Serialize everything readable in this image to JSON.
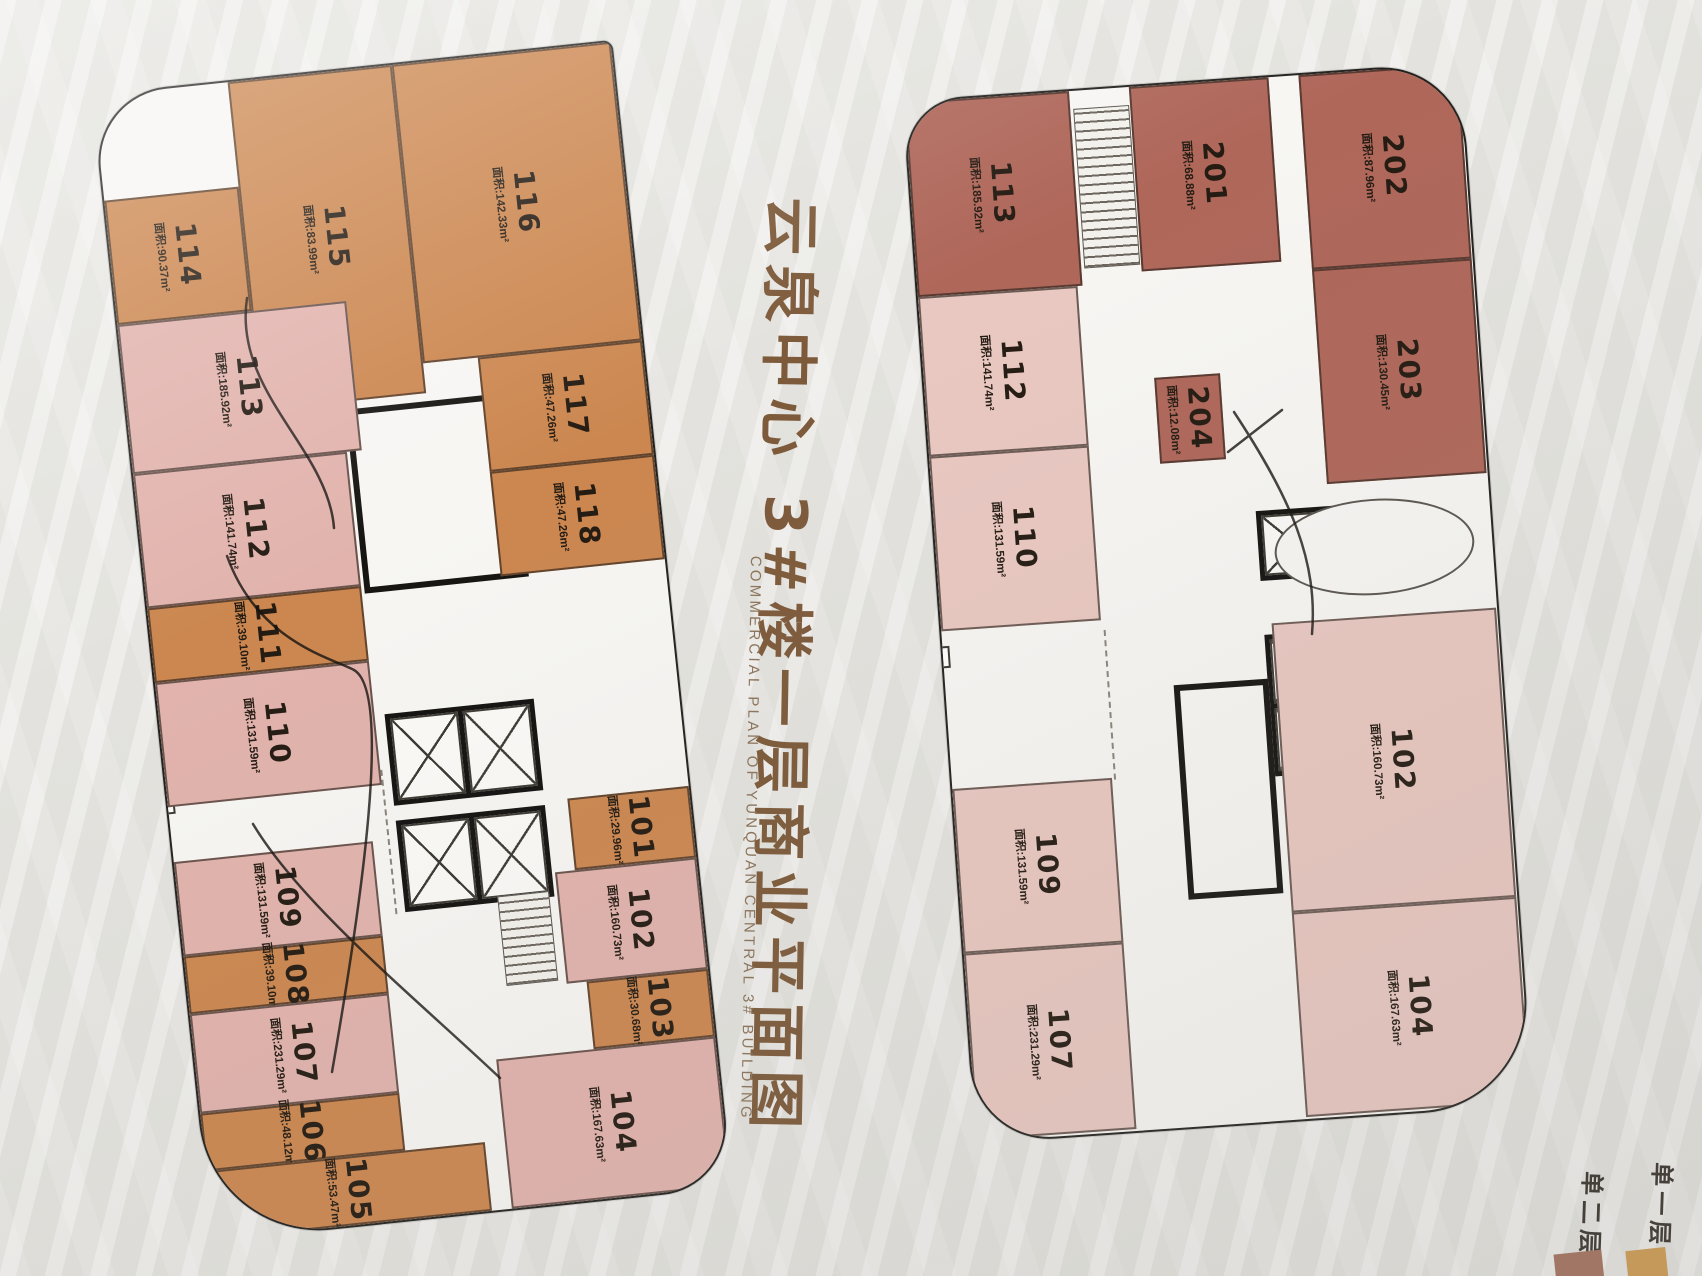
{
  "title": {
    "cn": "云泉中心 3#楼一层商业平面图",
    "en": "COMMERCIAL PLAN OF YUNQUAN CENTRAL 3# BUILDING"
  },
  "area_prefix": "面积:",
  "legend": {
    "items": [
      {
        "label": "单二层",
        "color": "#a3705c"
      },
      {
        "label": "单一层",
        "color": "#cf9a4f"
      }
    ]
  },
  "colors": {
    "single_story_orange": "#cc8750",
    "two_story_brick": "#af675a",
    "pink_unit_left": "#e2b3ad",
    "pink_unit_right": "#e9c8c1",
    "plan_background": "#f7f6f3",
    "title_brown": "#7d5a3a"
  },
  "left_plan": {
    "units": [
      {
        "id": "114",
        "area": "90.37m²",
        "type": "orange",
        "rect": [
          0,
          105,
          135,
          125
        ]
      },
      {
        "id": "115",
        "area": "83.99m²",
        "type": "orange",
        "rect": [
          135,
          0,
          165,
          330
        ]
      },
      {
        "id": "116",
        "area": "142.33m²",
        "type": "orange",
        "rect": [
          300,
          0,
          220,
          300
        ]
      },
      {
        "id": "117",
        "area": "47.26m²",
        "type": "orange",
        "rect": [
          355,
          300,
          165,
          115
        ]
      },
      {
        "id": "118",
        "area": "47.26m²",
        "type": "orange",
        "rect": [
          355,
          415,
          165,
          105
        ]
      },
      {
        "id": "113",
        "area": "185.92m²",
        "type": "pink",
        "rect": [
          0,
          230,
          230,
          150
        ]
      },
      {
        "id": "112",
        "area": "141.74m²",
        "type": "pink",
        "rect": [
          0,
          380,
          215,
          135
        ]
      },
      {
        "id": "111",
        "area": "39.10m²",
        "type": "orange",
        "rect": [
          0,
          515,
          215,
          75
        ]
      },
      {
        "id": "110",
        "area": "131.59m²",
        "type": "pink",
        "rect": [
          0,
          590,
          215,
          125
        ]
      },
      {
        "id": "109",
        "area": "131.59m²",
        "type": "pink",
        "rect": [
          0,
          770,
          200,
          95
        ]
      },
      {
        "id": "108",
        "area": "39.10m²",
        "type": "orange",
        "rect": [
          0,
          865,
          200,
          58
        ]
      },
      {
        "id": "107",
        "area": "231.29m²",
        "type": "pink",
        "rect": [
          0,
          923,
          200,
          100
        ]
      },
      {
        "id": "106",
        "area": "48.12m²",
        "type": "orange",
        "rect": [
          0,
          1023,
          200,
          58
        ]
      },
      {
        "id": "105",
        "area": "53.47m²",
        "type": "orange",
        "rect": [
          0,
          1081,
          280,
          69
        ]
      },
      {
        "id": "101",
        "area": "29.96m²",
        "type": "orange",
        "rect": [
          398,
          748,
          122,
          72
        ]
      },
      {
        "id": "102",
        "area": "160.73m²",
        "type": "pink",
        "rect": [
          378,
          820,
          142,
          112
        ]
      },
      {
        "id": "103",
        "area": "30.68m²",
        "type": "orange",
        "rect": [
          398,
          932,
          122,
          68
        ]
      },
      {
        "id": "104",
        "area": "167.63m²",
        "type": "pink",
        "rect": [
          300,
          1000,
          220,
          150
        ]
      }
    ]
  },
  "right_plan": {
    "units": [
      {
        "id": "113",
        "area": "185.92m²",
        "type": "brick",
        "rect": [
          0,
          0,
          165,
          195
        ]
      },
      {
        "id": "201",
        "area": "68.88m²",
        "type": "brick",
        "rect": [
          225,
          0,
          140,
          185
        ]
      },
      {
        "id": "202",
        "area": "87.96m²",
        "type": "brick",
        "rect": [
          395,
          0,
          160,
          195
        ]
      },
      {
        "id": "203",
        "area": "130.45m²",
        "type": "brick",
        "rect": [
          395,
          195,
          160,
          215
        ]
      },
      {
        "id": "112",
        "area": "141.74m²",
        "type": "pink",
        "rect": [
          0,
          195,
          160,
          160
        ]
      },
      {
        "id": "110",
        "area": "131.59m²",
        "type": "pink",
        "rect": [
          0,
          355,
          160,
          175
        ]
      },
      {
        "id": "204",
        "area": "12.08m²",
        "type": "brick",
        "rect": [
          230,
          292,
          66,
          86
        ]
      },
      {
        "id": "109",
        "area": "131.59m²",
        "type": "pink",
        "rect": [
          0,
          688,
          160,
          165
        ]
      },
      {
        "id": "107",
        "area": "231.29m²",
        "type": "pink",
        "rect": [
          0,
          853,
          160,
          187
        ]
      },
      {
        "id": "102",
        "area": "160.73m²",
        "type": "pink",
        "rect": [
          330,
          545,
          225,
          290
        ]
      },
      {
        "id": "104",
        "area": "167.63m²",
        "type": "pink",
        "rect": [
          330,
          835,
          225,
          205
        ]
      }
    ]
  }
}
